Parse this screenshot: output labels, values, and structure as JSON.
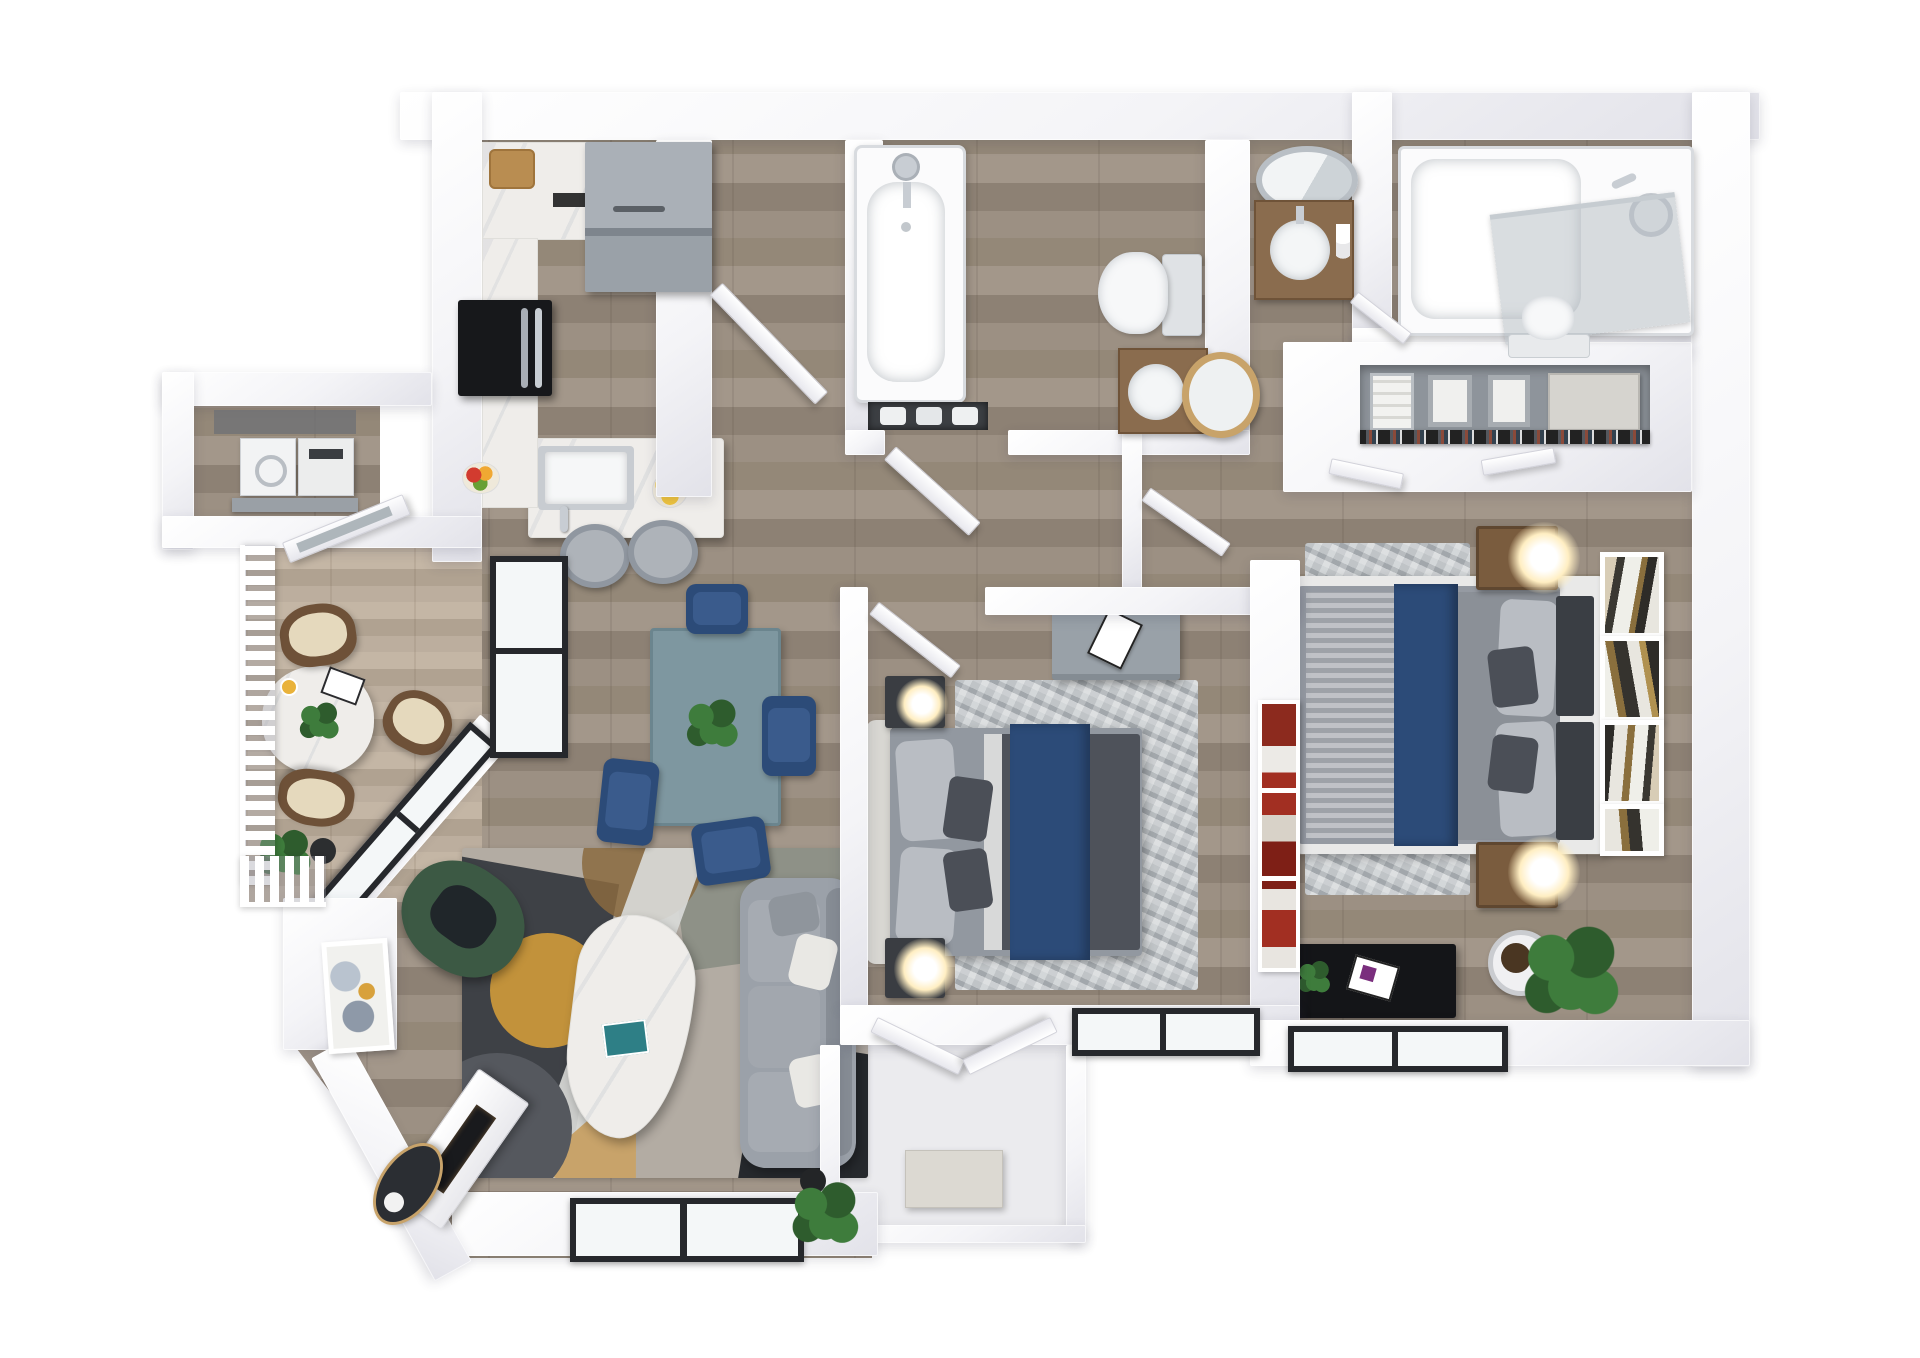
{
  "app": {
    "name": "apartment-3d-floor-plan-rendering",
    "view": "top-down-dollhouse",
    "visible_text": "none"
  },
  "colors": {
    "bg": "#ffffff",
    "wallA": "#f4f4f7",
    "wallB": "#e2e2e9",
    "wood1": "#9c9083",
    "wood2": "#8d8174",
    "wood3": "#a3978a",
    "wood4": "#948878",
    "balc1": "#bcae9e",
    "balc2": "#b0a291",
    "balc3": "#c4b6a5",
    "porchFloor": "#ebebee",
    "marble": "#efedea",
    "steel": "#c8cdd3",
    "grayAppliance": "#9aa1a8",
    "black": "#17181b",
    "navy": "#2c4b78",
    "navyL": "#3a5b8c",
    "duvet": "#4e525a",
    "blanket": "#a7abb1",
    "pillowL": "#b9bdc3",
    "pillowD": "#4b4f57",
    "headboard": "#d8d7d2",
    "headboardD": "#3a3e44",
    "rugLight": "#b8bdc0",
    "geoBase": "#b3aca3",
    "geoCharcoal": "#3e4146",
    "geoDark": "#26292d",
    "geoSage": "#8e9187",
    "geoGold": "#c2923b",
    "geoTan": "#c8a36a",
    "geoLight": "#d9dad8",
    "sofa": "#9ba1a9",
    "sofaDark": "#878d95",
    "cushion": "#e9e8e4",
    "green": "#3c5944",
    "greenDark": "#20262a",
    "woodFurn": "#7a5c3e",
    "woodCounter": "#8a6c4e",
    "deskGray": "#99a1a8",
    "tableBlue": "#7e97a0",
    "tableBlueD": "#6b858e",
    "glass": "#f4f7f8",
    "glassTint": "rgba(170,180,186,0.45)",
    "frameDark": "#26282c",
    "artRed": "#a22f22",
    "plantG": "#3e7c3c",
    "plantD": "#2e5c2d",
    "glow": "#ffeec2",
    "wickerD": "#6e5138",
    "wickerC": "#e5d9bd",
    "tub": "#fbfbfc",
    "tubEdge": "#d8dbdf",
    "nicheDark": "#3c3f43",
    "closetBack": "#8e949b",
    "consoleBlack": "#141518"
  },
  "scene": {
    "style": "rendered 3d floor plan, white walls, gray wood flooring, navy blue accents",
    "rooms": [
      {
        "name": "kitchen",
        "furniture": [
          "l-shaped-marble-counter",
          "cutting-board",
          "black-french-door-refrigerator",
          "gray-range-with-hood",
          "island-with-sink",
          "chrome-faucet",
          "bowl-of-lemons",
          "fruit-bowl",
          "two-gray-bar-stools"
        ]
      },
      {
        "name": "laundry-closet",
        "furniture": [
          "washer",
          "dryer",
          "shelf",
          "open-door"
        ]
      },
      {
        "name": "balcony",
        "furniture": [
          "white-slat-railing",
          "oval-marble-table",
          "three-wicker-chairs",
          "magazine",
          "coffee-cup",
          "potted-plants",
          "open-glass-door"
        ]
      },
      {
        "name": "dining-area",
        "furniture": [
          "blue-gray-rectangular-table",
          "four-navy-chairs",
          "centerpiece-plant"
        ]
      },
      {
        "name": "living-room",
        "furniture": [
          "geometric-area-rug",
          "gray-sofa-with-pillows",
          "green-velvet-armchair",
          "organic-marble-coffee-table",
          "teal-book",
          "angled-fireplace-console",
          "oval-dark-tray",
          "abstract-wall-art",
          "dark-framed-windows",
          "floor-plant"
        ]
      },
      {
        "name": "bedroom-1",
        "furniture": [
          "bed-with-navy-runner",
          "tufted-headboard",
          "two-dark-nightstands",
          "glowing-globe-lamps",
          "gray-distressed-rug",
          "gray-desk-with-magazine",
          "red-abstract-art",
          "open-door",
          "white-french-doors",
          "dark-framed-window"
        ]
      },
      {
        "name": "entry-porch",
        "furniture": [
          "bench"
        ]
      },
      {
        "name": "bathroom-1",
        "furniture": [
          "bathtub-with-chrome-shower",
          "towel-niche",
          "toilet",
          "wood-vanity",
          "round-vessel-sink",
          "round-leaning-mirror",
          "open-door"
        ]
      },
      {
        "name": "bathroom-2",
        "furniture": [
          "wood-vanity",
          "oval-chrome-mirror",
          "round-vessel-sink",
          "toiletries",
          "tub-with-glass-screen",
          "toilet",
          "open-door"
        ]
      },
      {
        "name": "walk-in-closet",
        "furniture": [
          "gray-shelf",
          "towel-stacks",
          "two-baskets",
          "storage-box",
          "hanging-clothes-rod",
          "two-closet-doors"
        ]
      },
      {
        "name": "master-bedroom",
        "furniture": [
          "king-bed-navy-runner",
          "charcoal-headboard-panels",
          "two-wood-nightstands",
          "glowing-sphere-lamps",
          "gray-distressed-rug",
          "gallery-wall-four-frames",
          "black-media-console",
          "magazine",
          "potted-fiddle-plant",
          "dark-framed-window"
        ]
      }
    ]
  }
}
